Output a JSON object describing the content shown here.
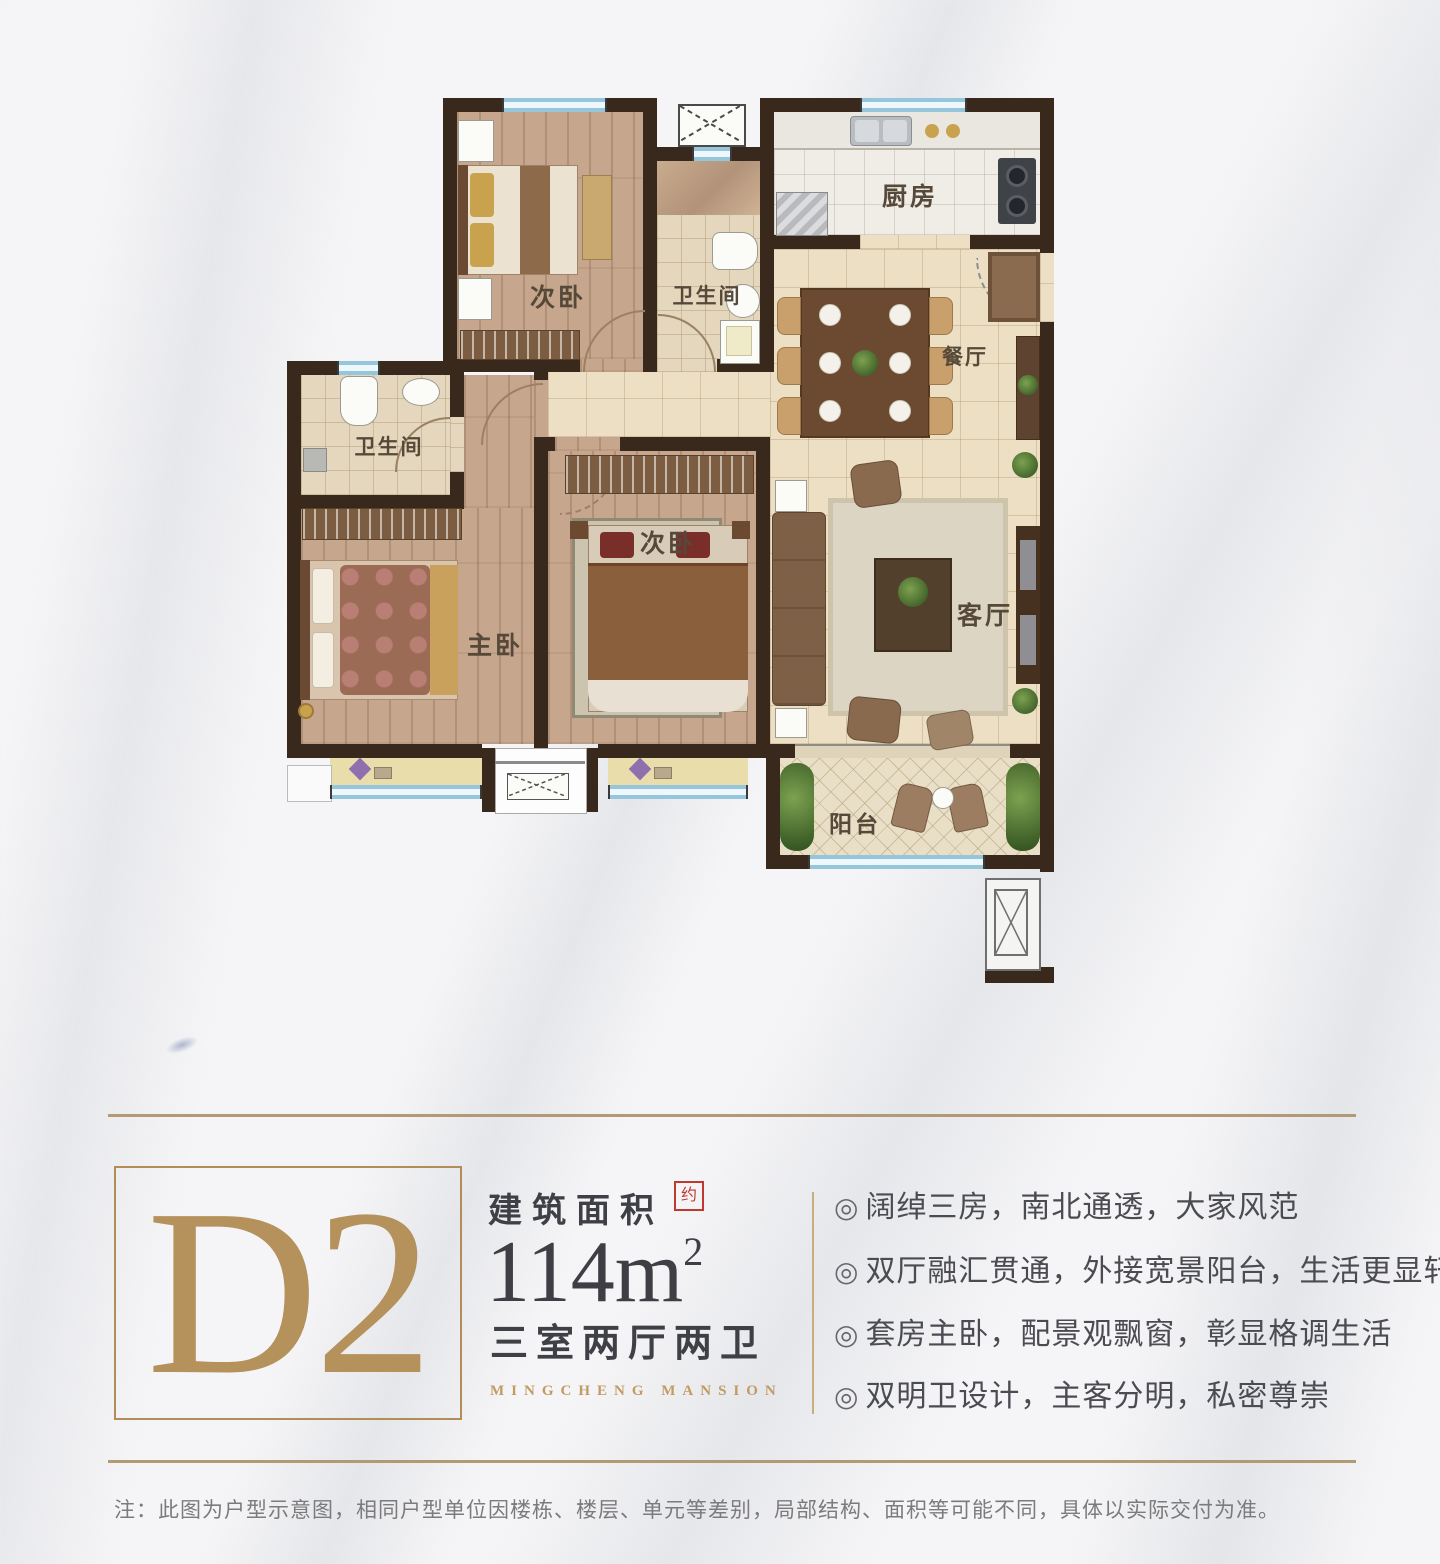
{
  "floor_plan": {
    "rooms": [
      {
        "id": "bedroom-north",
        "label": "次卧"
      },
      {
        "id": "bathroom-guest",
        "label": "卫生间"
      },
      {
        "id": "kitchen",
        "label": "厨房"
      },
      {
        "id": "dining-room",
        "label": "餐厅"
      },
      {
        "id": "living-room",
        "label": "客厅"
      },
      {
        "id": "master-bedroom",
        "label": "主卧"
      },
      {
        "id": "bedroom-middle",
        "label": "次卧"
      },
      {
        "id": "bathroom-master",
        "label": "卫生间"
      },
      {
        "id": "balcony",
        "label": "阳台"
      }
    ],
    "symbols": {
      "shaft_top": "x-box",
      "bay_box_bottom": "x-box",
      "shaft_bottom_right": "x-box"
    }
  },
  "unit": {
    "code": "D2",
    "area_title": "建筑面积",
    "area_seal": "约",
    "area_value": "114m",
    "area_exponent": "2",
    "layout": "三室两厅两卫",
    "project_en": "MINGCHENG MANSION"
  },
  "features": {
    "marker": "◎",
    "items": [
      "阔绰三房，南北通透，大家风范",
      "双厅融汇贯通，外接宽景阳台，生活更显轩昂",
      "套房主卧，配景观飘窗，彰显格调生活",
      "双明卫设计，主客分明，私密尊崇"
    ]
  },
  "disclaimer": "注：此图为户型示意图，相同户型单位因楼栋、楼层、单元等差别，局部结构、面积等可能不同，具体以实际交付为准。",
  "colors": {
    "gold": "#b28d56",
    "wall": "#39291d",
    "window_blue": "#a9d2e6",
    "text_dark": "#3f3f46",
    "seal_red": "#c0392f",
    "feature_text": "#4b4b52",
    "disclaimer_gray": "#7b7b7d",
    "wood_floor": "#c6a68c",
    "tile_floor": "#ecdfc4"
  }
}
